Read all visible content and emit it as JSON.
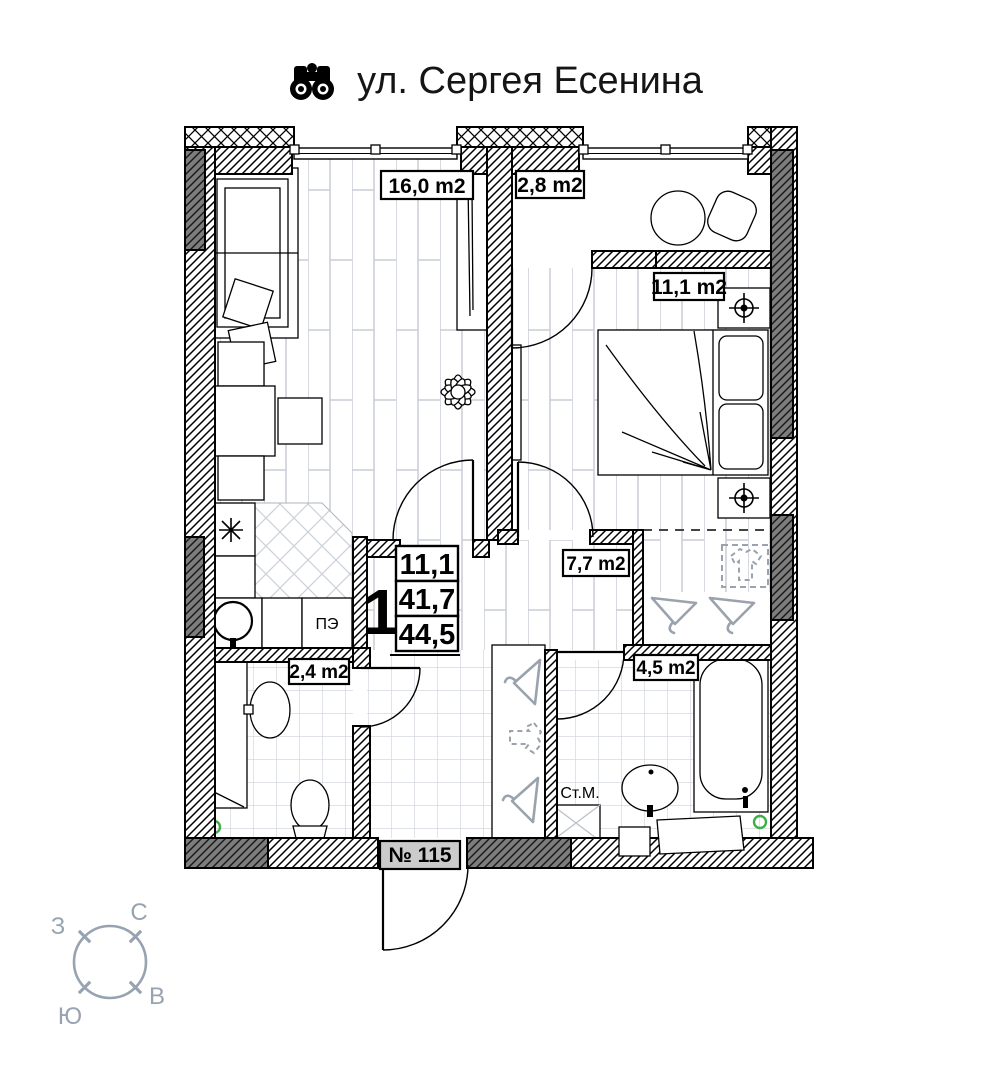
{
  "title": {
    "text": "ул. Сергея Есенина"
  },
  "apartment": {
    "number": "№ 115",
    "rooms_count": "1",
    "area_living": "11,1",
    "area_main": "41,7",
    "area_total": "44,5"
  },
  "room_labels": {
    "living": "16,0 m2",
    "balcony": "2,8 m2",
    "bedroom": "11,1 m2",
    "hall": "7,7 m2",
    "wc": "2,4 m2",
    "bath": "4,5 m2"
  },
  "appliances": {
    "stove": "ПЭ",
    "washer": "Ст.М."
  },
  "compass": {
    "north": "С",
    "south": "Ю",
    "west": "З",
    "east": "В"
  },
  "colors": {
    "wall_dark": "#7d7d7d",
    "floor_line": "#c8cdd6",
    "compass": "#98a3b1",
    "vent_green": "#3fae49",
    "number_bg": "#cbcbcb"
  }
}
